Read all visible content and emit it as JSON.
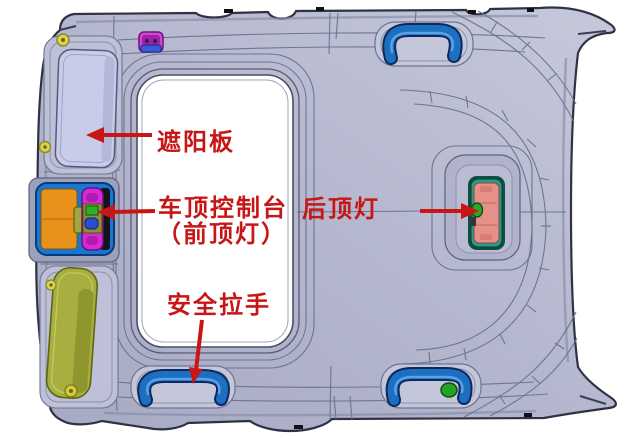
{
  "annotations": {
    "sun_visor": "遮阳板",
    "roof_console_line1": "车顶控制台",
    "roof_console_line2": "（前顶灯）",
    "rear_dome_light": "后顶灯",
    "safety_grab_handle": "安全拉手"
  },
  "colors": {
    "annotation_red": "#c81616",
    "headliner_body": "#b4b7ce",
    "headliner_highlight": "#c6c8da",
    "panel_line": "#6f7490",
    "outline_dark": "#2f3245",
    "sunroof_opening": "#ffffff",
    "grab_handle_blue": "#1d6fc0",
    "console_frame_blue": "#1877d4",
    "console_orange": "#e8921c",
    "console_magenta": "#d62ad6",
    "console_lamp_green": "#2fae2f",
    "console_lamp_blue": "#2a4ed2",
    "passenger_visor_lavender": "#c9cce8",
    "driver_visor_olive": "#a9ae40",
    "rear_light_teal": "#2b9a86",
    "rear_light_salmon": "#e59088",
    "clip_yellow": "#d9d552",
    "clip_green": "#26a226",
    "clip_magenta": "#cb4ad2"
  },
  "components": [
    {
      "name": "passenger-sun-visor"
    },
    {
      "name": "driver-sun-visor"
    },
    {
      "name": "overhead-console-front-dome-light"
    },
    {
      "name": "rear-dome-light"
    },
    {
      "name": "grab-handle-top-right"
    },
    {
      "name": "grab-handle-bottom-left"
    },
    {
      "name": "grab-handle-bottom-right"
    },
    {
      "name": "sunroof-opening"
    },
    {
      "name": "headliner-panel"
    }
  ]
}
